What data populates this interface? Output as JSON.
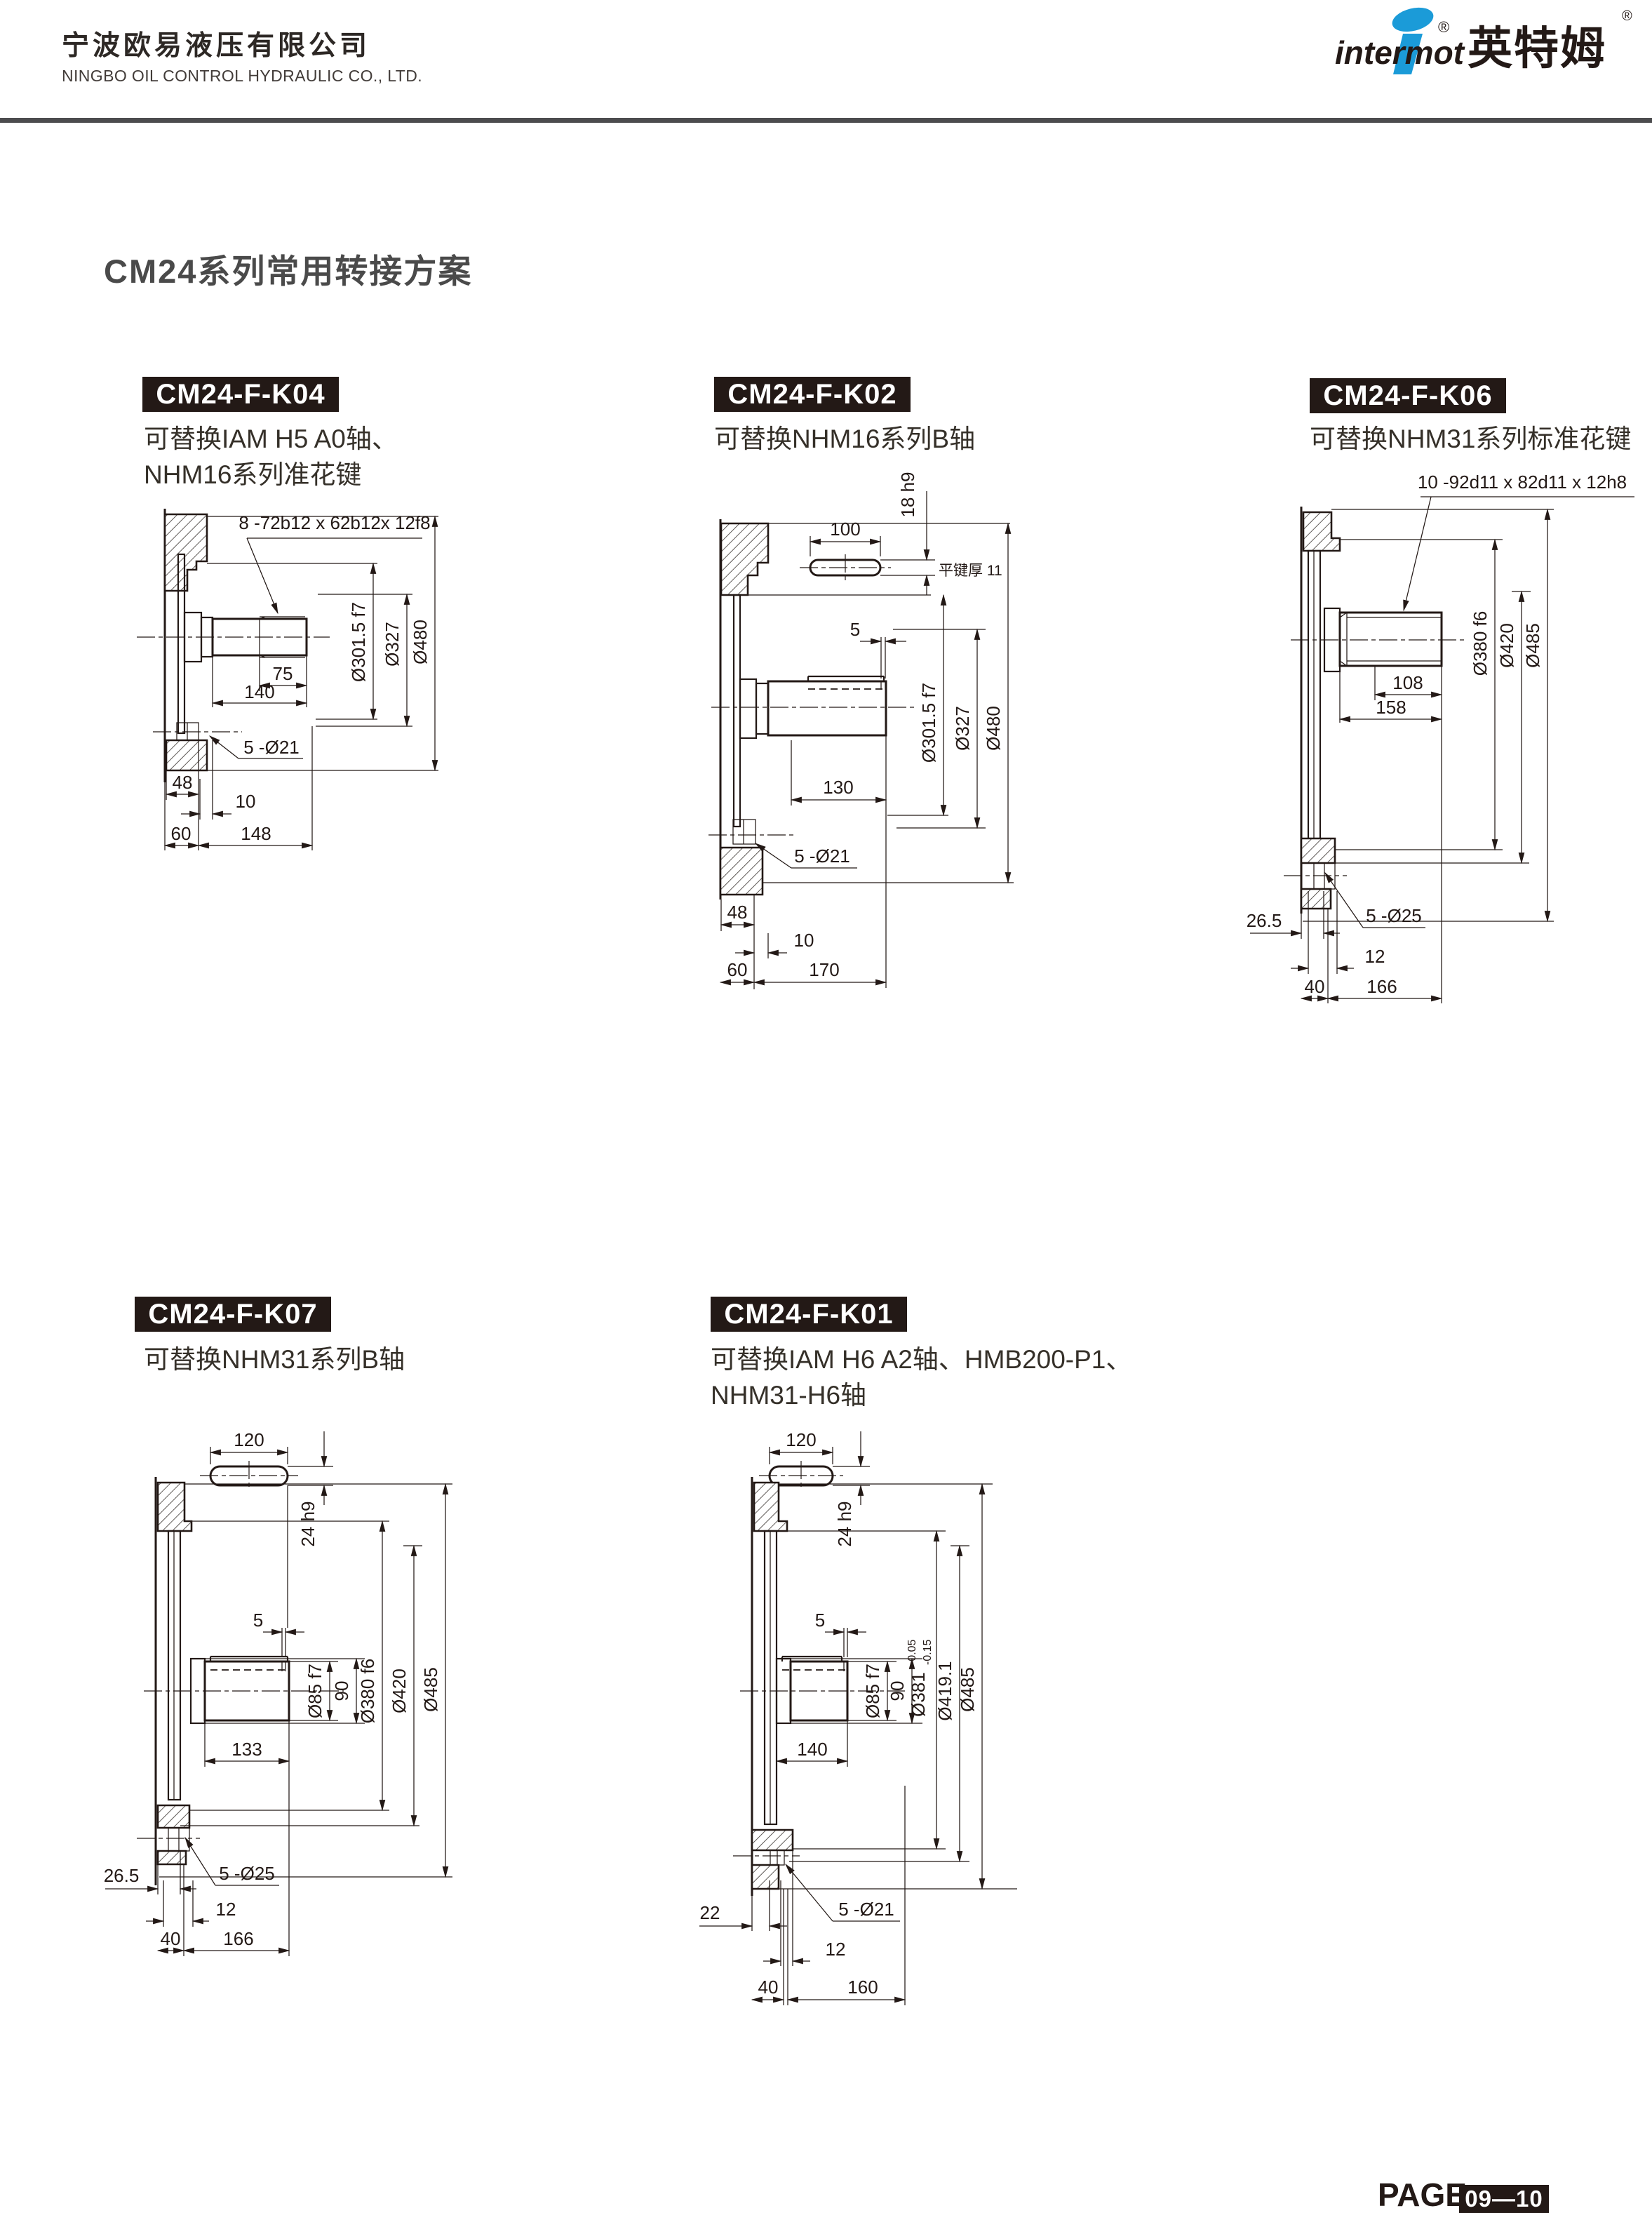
{
  "header": {
    "company_cn": "宁波欧易液压有限公司",
    "company_en": "NINGBO OIL CONTROL HYDRAULIC CO., LTD.",
    "brand_latin": "intermot",
    "brand_cn": "英特姆",
    "reg_mark": "®"
  },
  "title": "CM24系列常用转接方案",
  "footer": {
    "label": "PAGE",
    "page": "09—10"
  },
  "colors": {
    "ink": "#231916",
    "brand_blue": "#1b9bd8",
    "divider_gray": "#4c4c4e"
  },
  "drawings": {
    "k04": {
      "label": "CM24-F-K04",
      "desc1": "可替换IAM H5 A0轴、",
      "desc2": "NHM16系列准花键",
      "note": "8 -72b12 x 62b12x 12f8",
      "dia1": "Ø301.5 f7",
      "dia2": "Ø327",
      "dia3": "Ø480",
      "len1": "75",
      "len2": "140",
      "holes": "5 -Ø21",
      "f1": "48",
      "f2": "10",
      "f3": "60",
      "f4": "148"
    },
    "k02": {
      "label": "CM24-F-K02",
      "desc1": "可替换NHM16系列B轴",
      "key_len": "100",
      "key_w": "18 h9",
      "key_note": "平键厚 11",
      "groove": "5",
      "dia1": "Ø301.5 f7",
      "dia2": "Ø327",
      "dia3": "Ø480",
      "len2": "130",
      "holes": "5 -Ø21",
      "f1": "48",
      "f2": "10",
      "f3": "60",
      "f4": "170"
    },
    "k06": {
      "label": "CM24-F-K06",
      "desc1": "可替换NHM31系列标准花键",
      "note": "10 -92d11 x 82d11 x 12h8",
      "dia1": "Ø380 f6",
      "dia2": "Ø420",
      "dia3": "Ø485",
      "len1": "108",
      "len2": "158",
      "holes": "5 -Ø25",
      "f1": "26.5",
      "f2": "12",
      "f3": "40",
      "f4": "166"
    },
    "k07": {
      "label": "CM24-F-K07",
      "desc1": "可替换NHM31系列B轴",
      "key_len": "120",
      "key_w": "24 h9",
      "groove": "5",
      "diaS": "Ø85 f7",
      "diaS2": "90",
      "dia1": "Ø380 f6",
      "dia2": "Ø420",
      "dia3": "Ø485",
      "len2": "133",
      "holes": "5 -Ø25",
      "f1": "26.5",
      "f2": "12",
      "f3": "40",
      "f4": "166"
    },
    "k01": {
      "label": "CM24-F-K01",
      "desc1": "可替换IAM H6 A2轴、HMB200-P1、",
      "desc2": "NHM31-H6轴",
      "key_len": "120",
      "key_w": "24 h9",
      "groove": "5",
      "diaS": "Ø85 f7",
      "diaS2": "90",
      "dia1": "Ø381",
      "dia1_hi": "-0.05",
      "dia1_lo": "-0.15",
      "dia2": "Ø419.1",
      "dia3": "Ø485",
      "len2": "140",
      "holes": "5 -Ø21",
      "f1": "22",
      "f2": "12",
      "f3": "40",
      "f4": "160"
    }
  }
}
